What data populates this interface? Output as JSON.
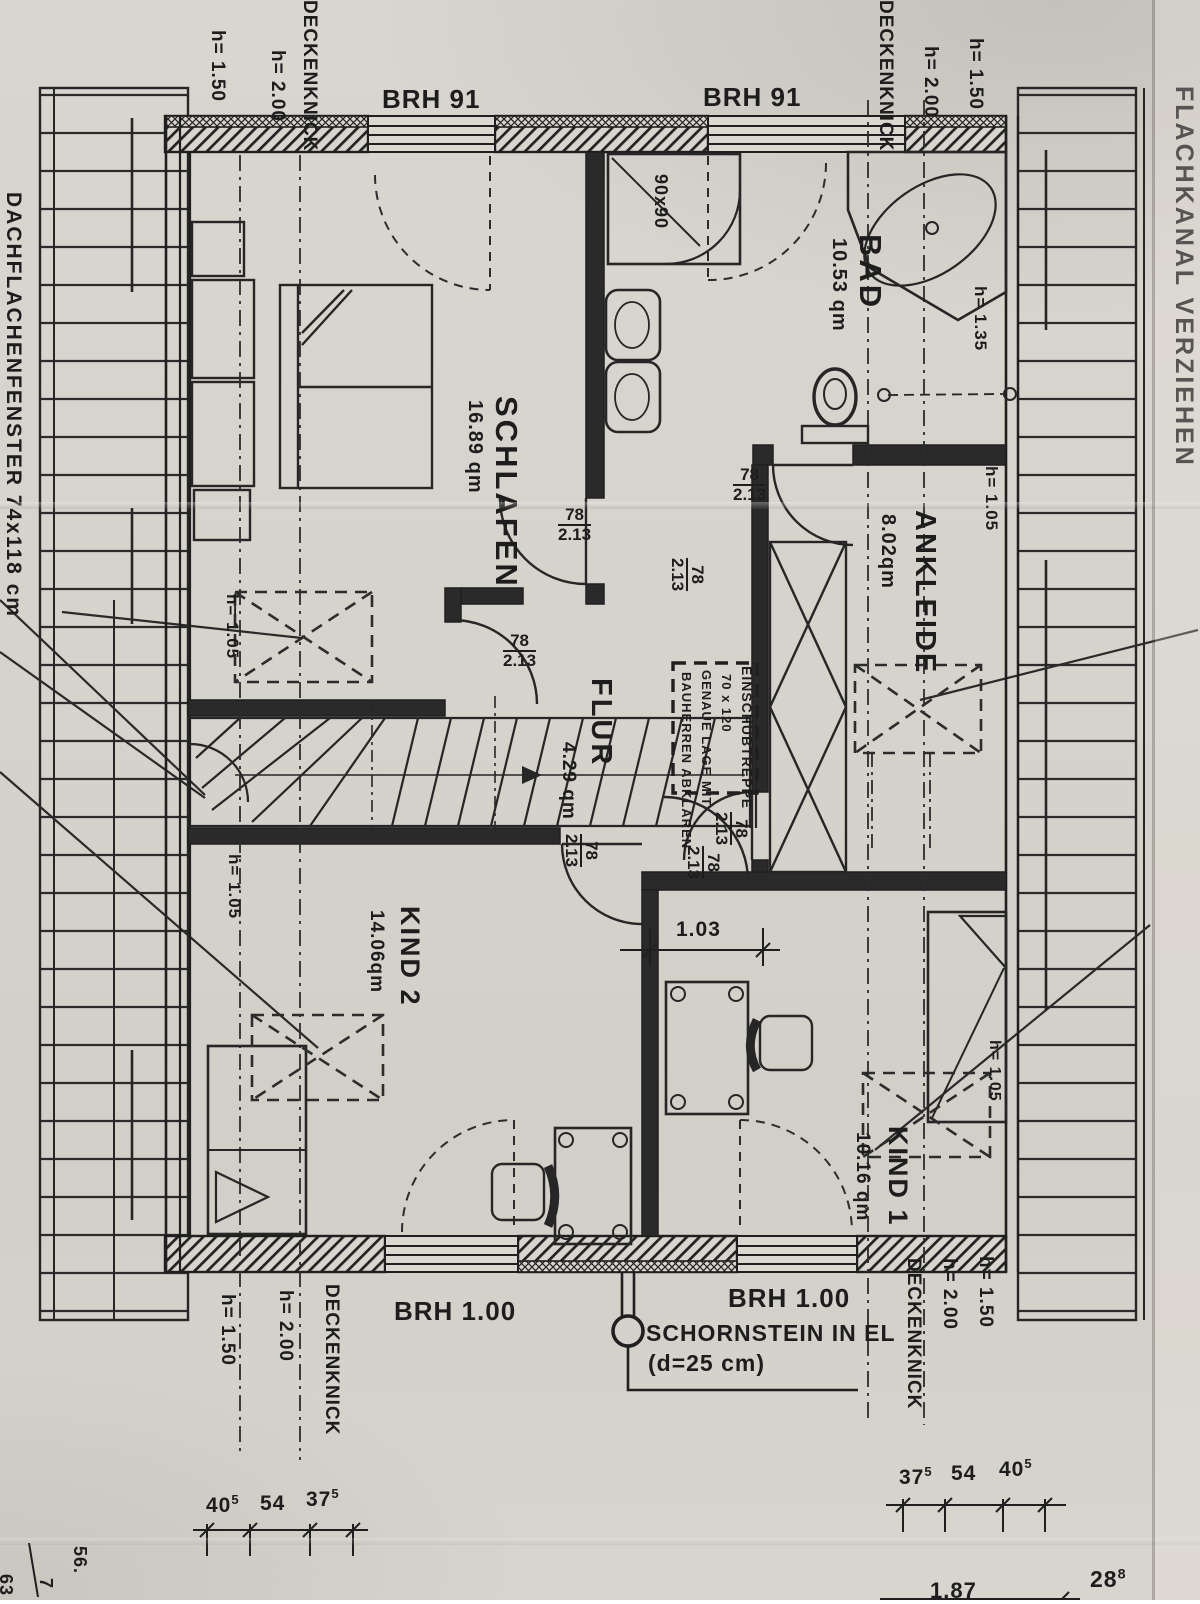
{
  "edge": {
    "left": "DACHFLACHENFENSTER  74x118 cm",
    "right": "FLACHKANAL VERZIEHEN"
  },
  "labels": {
    "deckenknick": "DECKENKNICK",
    "h150": "h= 1.50",
    "h200": "h= 2.00",
    "h135": "h= 1.35",
    "h105": "h= 1.05"
  },
  "rooms": {
    "schlafen": {
      "name": "SCHLAFEN",
      "area": "16.89 qm"
    },
    "bad": {
      "name": "BAD",
      "area": "10.53 qm"
    },
    "ankleide": {
      "name": "ANKLEIDE",
      "area": "8.02qm"
    },
    "flur": {
      "name": "FLUR",
      "area": "4.29 qm"
    },
    "kind2": {
      "name": "KIND 2",
      "area": "14.06qm"
    },
    "kind1": {
      "name": "KIND 1",
      "area": "10.16 qm"
    }
  },
  "win": {
    "top": "BRH 91",
    "bottom": "BRH 1.00"
  },
  "door": {
    "w": "78",
    "h": "2.13"
  },
  "shower": {
    "size": "90x90"
  },
  "stairnote": {
    "l1": "EINSCHUBTREPPE",
    "l2": "70 x 120",
    "l3": "GENAUE LAGE MIT",
    "l4": "BAUHERREN ABKLÄREN"
  },
  "chimney": {
    "l1": "SCHORNSTEIN IN EL",
    "l2": "(d=25 cm)"
  },
  "dims": {
    "niche": "1.03",
    "bl": [
      {
        "v": "40",
        "s": "5"
      },
      {
        "v": "54",
        "s": ""
      },
      {
        "v": "37",
        "s": "5"
      }
    ],
    "br": [
      {
        "v": "37",
        "s": "5"
      },
      {
        "v": "54",
        "s": ""
      },
      {
        "v": "40",
        "s": "5"
      }
    ]
  },
  "corner": {
    "c56": "56.",
    "c7": "7",
    "c63": "63",
    "a187": "1.87",
    "r28": "28",
    "r28s": "8"
  }
}
